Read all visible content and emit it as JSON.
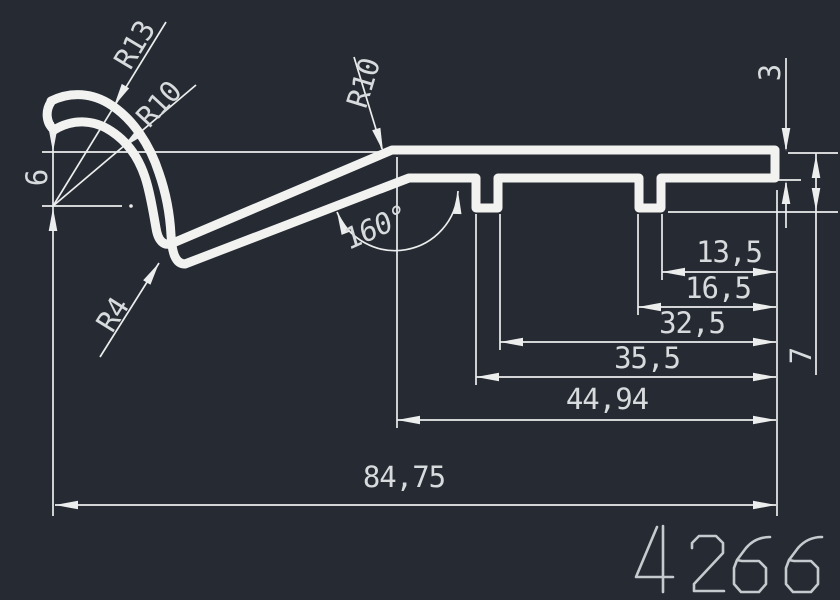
{
  "drawing": {
    "profile_number": "4266",
    "dimensions": {
      "total_width": "84,75",
      "flat_width": "44,94",
      "groove1_outer": "35,5",
      "groove1_inner": "32,5",
      "groove2_outer": "16,5",
      "groove2_inner": "13,5",
      "hook_depth": "6",
      "edge_thickness": "3",
      "groove_depth": "7",
      "bend_angle": "160°"
    },
    "radii": {
      "outer": "R13",
      "inner": "R10",
      "junction": "R10",
      "bend": "R4"
    },
    "colors": {
      "background": "#262a32",
      "profile_line": "#f2f3f1",
      "dimension_line": "#eceded",
      "label_text": "#d8dbdd",
      "profile_number": "#c5cacf"
    }
  }
}
